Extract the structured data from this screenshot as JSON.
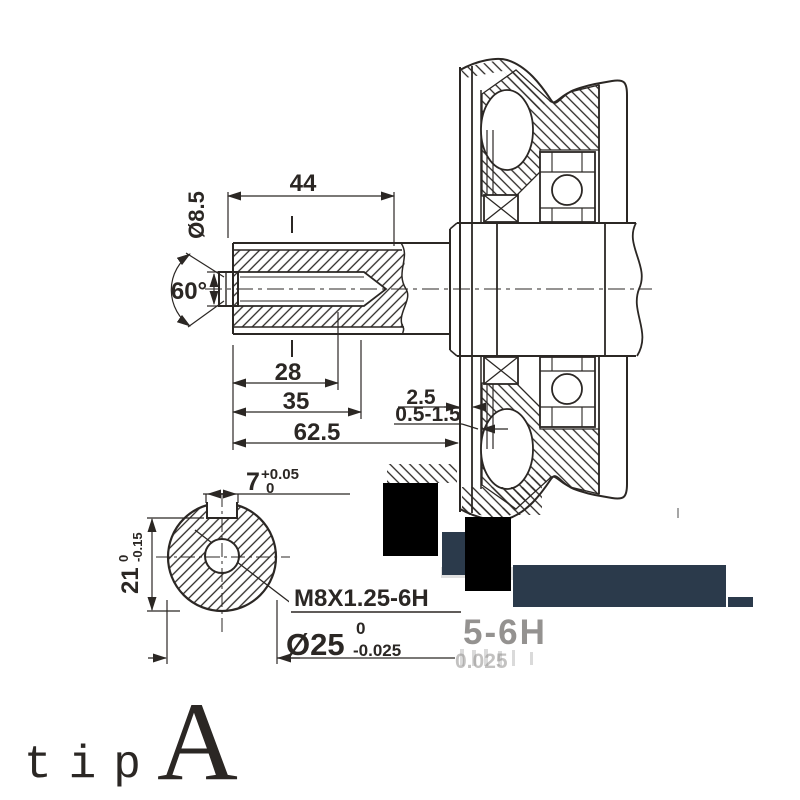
{
  "labels": {
    "dim_44": "44",
    "dim_diameter_8_5": "Ø8.5",
    "dim_angle_60": "60°",
    "dim_28": "28",
    "dim_35": "35",
    "dim_62_5": "62.5",
    "dim_2_5": "2.5",
    "dim_0_5_1_5": "0.5-1.5",
    "dim_7": "7",
    "dim_7_tol_upper": "+0.05",
    "dim_7_tol_lower": "0",
    "dim_21": "21",
    "dim_21_tol_upper": "0",
    "dim_21_tol_lower": "-0.15",
    "thread_spec": "M8X1.25-6H",
    "dim_25": "Ø25",
    "dim_25_tol_upper": "0",
    "dim_25_tol_lower": "-0.025"
  },
  "ghost": {
    "fragment_1": "5-6H",
    "fragment_2": "0.025"
  },
  "caption": {
    "prefix": "tip",
    "letter": "A"
  },
  "colors": {
    "line": "#2b2724",
    "redaction_black": "#000000",
    "redaction_navy": "#2b3a4b",
    "caption_red": "#ee4a43",
    "ghost_gray": "#8f8f8f"
  }
}
